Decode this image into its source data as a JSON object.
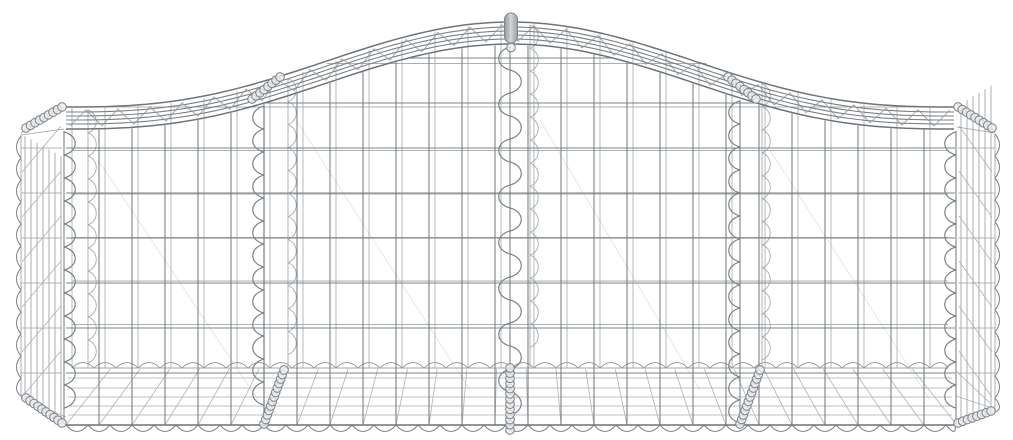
{
  "meta": {
    "description": "Product photo of an arched galvanised iron gabion basket wire mesh cage on a white background",
    "background_color": "#ffffff",
    "wire_color": "#74797d",
    "wire_color_light": "#9ea3a7",
    "metal_highlight": "#d6d9da"
  },
  "scene": {
    "canvas": {
      "w": 1013,
      "h": 440
    },
    "arch": {
      "left": 66,
      "right": 955,
      "endY": 129,
      "peakY": 44,
      "exp": 1.35
    },
    "backOffset": {
      "dx": 6,
      "dy": 22
    },
    "mesh": {
      "vx0": 66,
      "vstep": 33,
      "vcount": 28,
      "frontHoriz": [
        58,
        103,
        148,
        193,
        238,
        283,
        328,
        373
      ],
      "backHoriz": [
        63.5,
        107,
        150.5,
        194,
        237.5,
        281,
        324.5,
        368
      ],
      "frontBottomY": 425,
      "backBottomY": 368,
      "backLeft": 72,
      "backRight": 948
    },
    "band": {
      "offsets": [
        0,
        5,
        9,
        13,
        17,
        22
      ],
      "laceStep": 16,
      "laceHi": 3,
      "laceLo": 19,
      "x0": 70,
      "x1": 950
    },
    "spiralsFront": [
      {
        "x": 64,
        "side": 1
      },
      {
        "x": 264,
        "side": -1
      },
      {
        "x": 510,
        "side": "alt"
      },
      {
        "x": 740,
        "side": -1
      },
      {
        "x": 956,
        "side": -1
      }
    ],
    "spiralsBack": [
      {
        "x": 88
      },
      {
        "x": 288
      },
      {
        "x": 530
      },
      {
        "x": 762
      }
    ],
    "spiralShape": {
      "period": 23,
      "lobe": 15,
      "lobeBack": 11
    },
    "waves": [
      {
        "type": "h",
        "y": 425,
        "x0": 66,
        "x1": 955,
        "p": 22,
        "depth": 13,
        "dir": 1,
        "cls": "w-wave"
      },
      {
        "type": "h",
        "y": 368,
        "x0": 72,
        "x1": 948,
        "p": 22,
        "depth": 11,
        "dir": -1,
        "cls": "w-wave-back"
      },
      {
        "type": "v",
        "x": 21,
        "y0": 136,
        "y1": 396,
        "p": 22,
        "depth": 9,
        "dir": -1,
        "cls": "w-wave"
      },
      {
        "type": "v",
        "x": 995,
        "y0": 134,
        "y1": 412,
        "p": 22,
        "depth": 9,
        "dir": 1,
        "cls": "w-wave"
      }
    ],
    "sideLeft": {
      "lineX": 21,
      "lineTop": 135,
      "lineBot": 397,
      "verts": [
        25,
        31,
        37,
        43,
        49,
        55,
        61
      ],
      "vTopBase": 134,
      "vTopSlope": 0.55,
      "vBotBase": 397,
      "vBotSlope": 0.62,
      "refX": 21,
      "horiz": [
        148,
        193,
        238,
        283,
        328,
        373
      ],
      "hx0": 21,
      "hx1": 62,
      "diagTopX": 61,
      "diagBotX": 22,
      "wedges": [
        [
          21,
          135,
          64,
          129
        ],
        [
          21,
          133,
          64,
          107
        ],
        [
          21,
          397,
          64,
          424
        ]
      ]
    },
    "sideRight": {
      "lineX": 995,
      "lineTop": 134,
      "lineBot": 412,
      "verts": [
        961,
        967,
        973,
        979,
        985,
        991
      ],
      "vTopBase": 106,
      "vTopSlope": 0.6,
      "vBotBase": 424,
      "vBotSlope": -0.32,
      "refX": 957,
      "horiz": [
        148,
        193,
        238,
        283,
        328,
        373
      ],
      "hx0": 958,
      "hx1": 995,
      "diagTopX": 959,
      "diagBotX": 992,
      "wedges": [
        [
          995,
          133,
          957,
          127
        ],
        [
          995,
          131,
          957,
          104
        ],
        [
          995,
          412,
          957,
          424
        ]
      ]
    },
    "floor": {
      "horiz": [
        378,
        388,
        397,
        406,
        415
      ],
      "hx0": 68,
      "hx1": 952,
      "vTop": 369,
      "vBot": 424,
      "skew": 0.1,
      "fans": [
        [
          24,
          399,
          66,
          425
        ],
        [
          34,
          404,
          66,
          417
        ],
        [
          990,
          403,
          956,
          371
        ],
        [
          992,
          408,
          956,
          396
        ]
      ]
    },
    "braces": [
      [
        98,
        160,
        258,
        400
      ],
      [
        296,
        120,
        470,
        390
      ],
      [
        540,
        120,
        700,
        390
      ],
      [
        770,
        150,
        930,
        400
      ]
    ],
    "coilRuns": [
      [
        26,
        128,
        62,
        107
      ],
      [
        958,
        107,
        992,
        128
      ],
      [
        26,
        398,
        62,
        423
      ],
      [
        958,
        423,
        991,
        411
      ],
      [
        252,
        99,
        280,
        77
      ],
      [
        728,
        77,
        756,
        99
      ],
      [
        264,
        424,
        284,
        370
      ],
      [
        740,
        424,
        760,
        370
      ],
      [
        510,
        430,
        510,
        368
      ]
    ],
    "coil": {
      "r": 4.3,
      "spacing": 5
    },
    "apexPin": {
      "x": 511,
      "top": 13,
      "bottom": 43,
      "w": 13,
      "ringY": 47.5,
      "ringR": 4.3
    }
  }
}
